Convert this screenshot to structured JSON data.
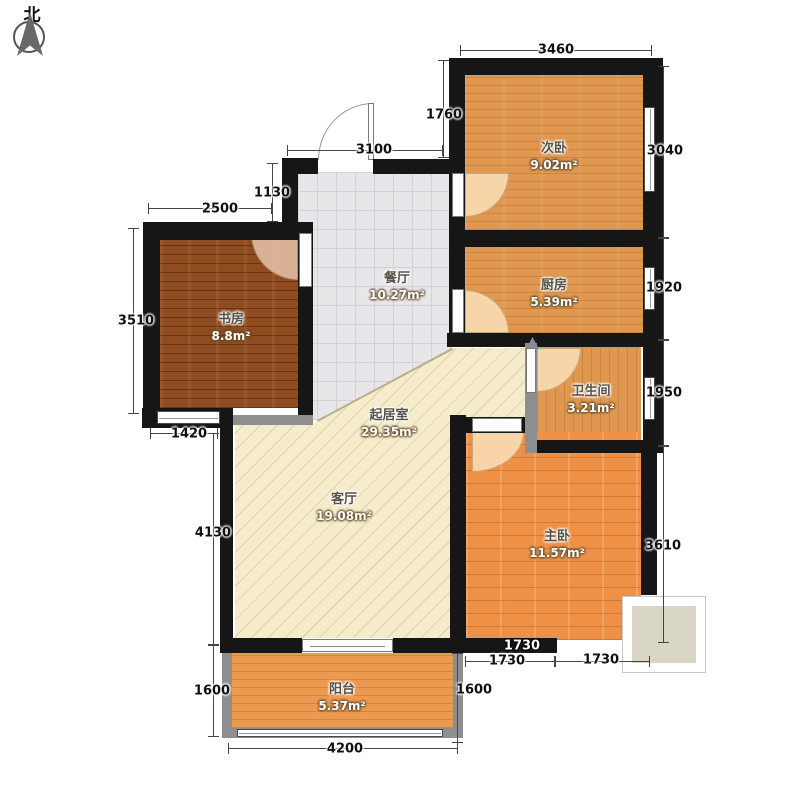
{
  "compass": {
    "label": "北"
  },
  "rooms": [
    {
      "id": "study",
      "name": "书房",
      "area": "8.8m²"
    },
    {
      "id": "dining",
      "name": "餐厅",
      "area": "10.27m²"
    },
    {
      "id": "bedroom2",
      "name": "次卧",
      "area": "9.02m²"
    },
    {
      "id": "kitchen",
      "name": "厨房",
      "area": "5.39m²"
    },
    {
      "id": "bathroom",
      "name": "卫生间",
      "area": "3.21m²"
    },
    {
      "id": "family",
      "name": "起居室",
      "area": "29.35m²"
    },
    {
      "id": "living",
      "name": "客厅",
      "area": "19.08m²"
    },
    {
      "id": "master",
      "name": "主卧",
      "area": "11.57m²"
    },
    {
      "id": "balcony",
      "name": "阳台",
      "area": "5.37m²"
    }
  ],
  "dims": [
    {
      "id": "top-3460",
      "value": "3460"
    },
    {
      "id": "v-1760",
      "value": "1760"
    },
    {
      "id": "h-3100",
      "value": "3100"
    },
    {
      "id": "v-1130",
      "value": "1130"
    },
    {
      "id": "h-2500",
      "value": "2500"
    },
    {
      "id": "v-3510",
      "value": "3510"
    },
    {
      "id": "h-1420",
      "value": "1420"
    },
    {
      "id": "v-4130",
      "value": "4130"
    },
    {
      "id": "v-1600-left",
      "value": "1600"
    },
    {
      "id": "h-4200",
      "value": "4200"
    },
    {
      "id": "v-1600-right",
      "value": "1600"
    },
    {
      "id": "wall-1730",
      "value": "1730"
    },
    {
      "id": "h-1730-left",
      "value": "1730"
    },
    {
      "id": "h-1730-right",
      "value": "1730"
    },
    {
      "id": "v-3040",
      "value": "3040"
    },
    {
      "id": "v-1920",
      "value": "1920"
    },
    {
      "id": "v-1950",
      "value": "1950"
    },
    {
      "id": "v-3610",
      "value": "3610"
    }
  ],
  "colors": {
    "wall": "#161616",
    "gray_wall": "#8e8e8e",
    "bedroom_floor": "#e09750",
    "master_floor": "#ee9147",
    "study_floor": "#8f4c20",
    "dining_tile": "#e7e7ea",
    "living_floor": "#f5eccb",
    "terrace_fill": "#d9d5c7"
  }
}
